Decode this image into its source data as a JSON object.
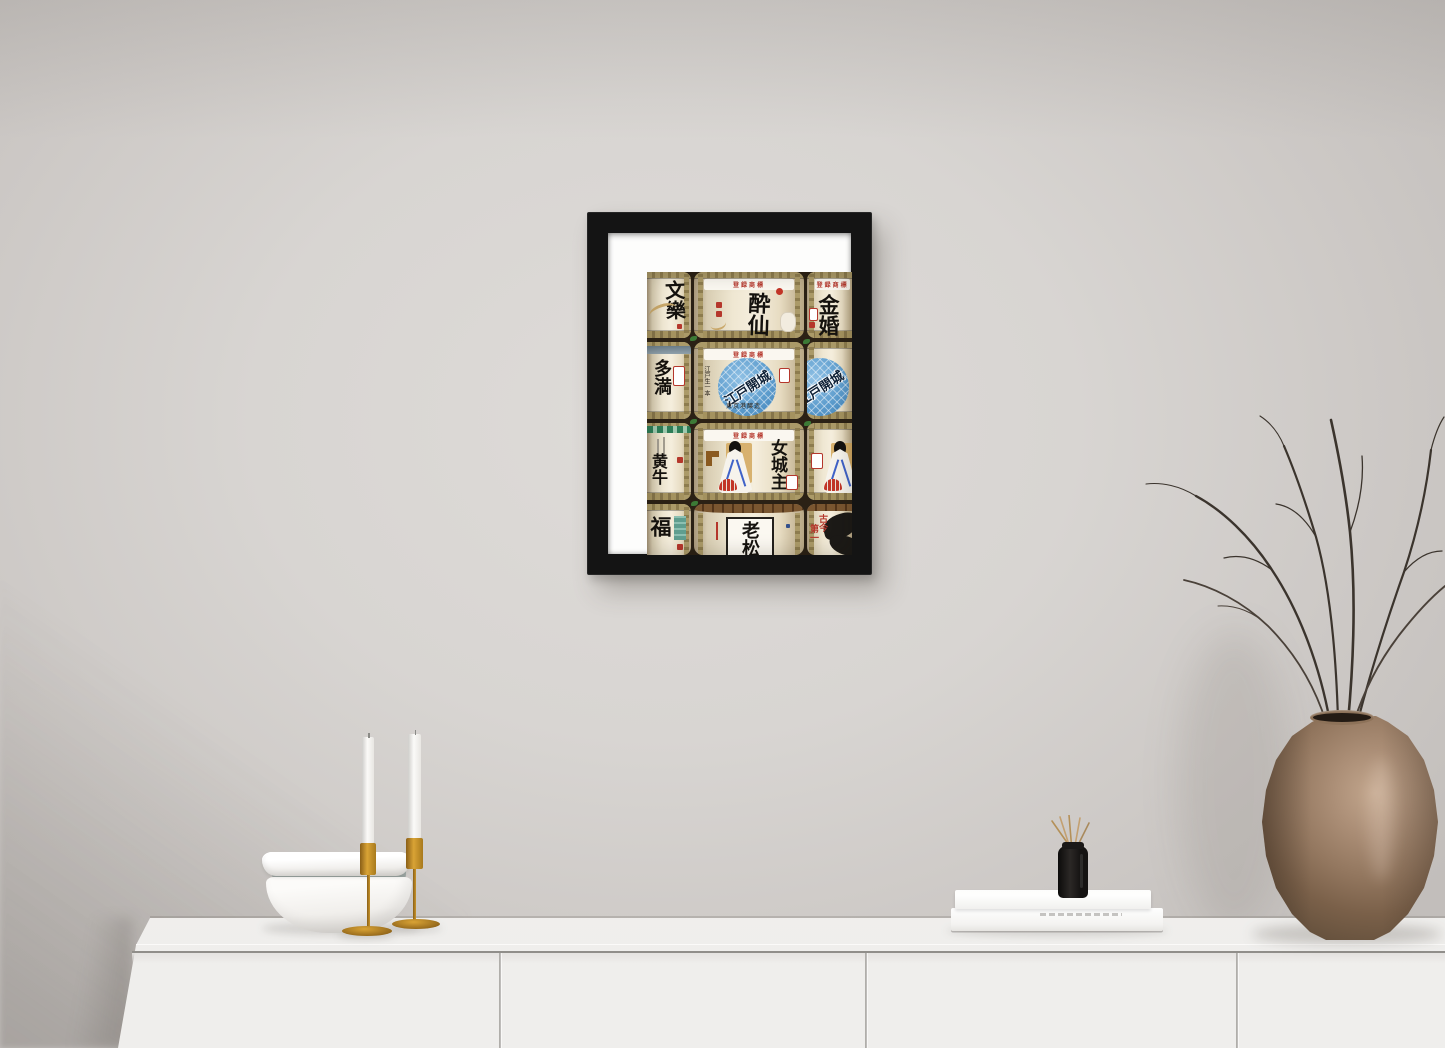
{
  "art_print": {
    "rows": [
      {
        "left": {
          "main": "文樂"
        },
        "center": {
          "top_label": "登録商標",
          "main": "酔仙"
        },
        "right": {
          "top_label": "登録商標",
          "main": "金婚"
        }
      },
      {
        "left": {
          "main": "多満"
        },
        "center": {
          "top_label": "登録商標",
          "circle": "江戸開城",
          "side_note": "江戸生一本",
          "bottom_note": "東京港醸造"
        },
        "right": {}
      },
      {
        "left": {
          "main": "黄牛"
        },
        "center": {
          "top_label": "登録商標",
          "main": "女城主"
        },
        "right": {}
      },
      {
        "left": {
          "main": "福"
        },
        "center": {
          "main": "老松"
        },
        "right": {
          "main_a": "古今",
          "main_b": "第一"
        }
      }
    ]
  },
  "palette": {
    "wall": "#d6d2cf",
    "frame_black": "#141414",
    "mat_white": "#fdfdfc",
    "barrel_cream": "#efe7d2",
    "rope_khaki": "#a4925f",
    "seal_red": "#b5372c",
    "logo_blue": "#5b9bcc",
    "leaf_green": "#3c7a36",
    "ink_black": "#15120e",
    "cabinet_white": "#f3f2f1",
    "brass_gold": "#c9952c",
    "candle_white": "#f7f6f3",
    "bowl_gray": "#97a09d",
    "book_white": "#f7f6f4",
    "diffuser_black": "#151312",
    "vase_bronze": "#8a7058",
    "branch_brown": "#3b342d"
  }
}
